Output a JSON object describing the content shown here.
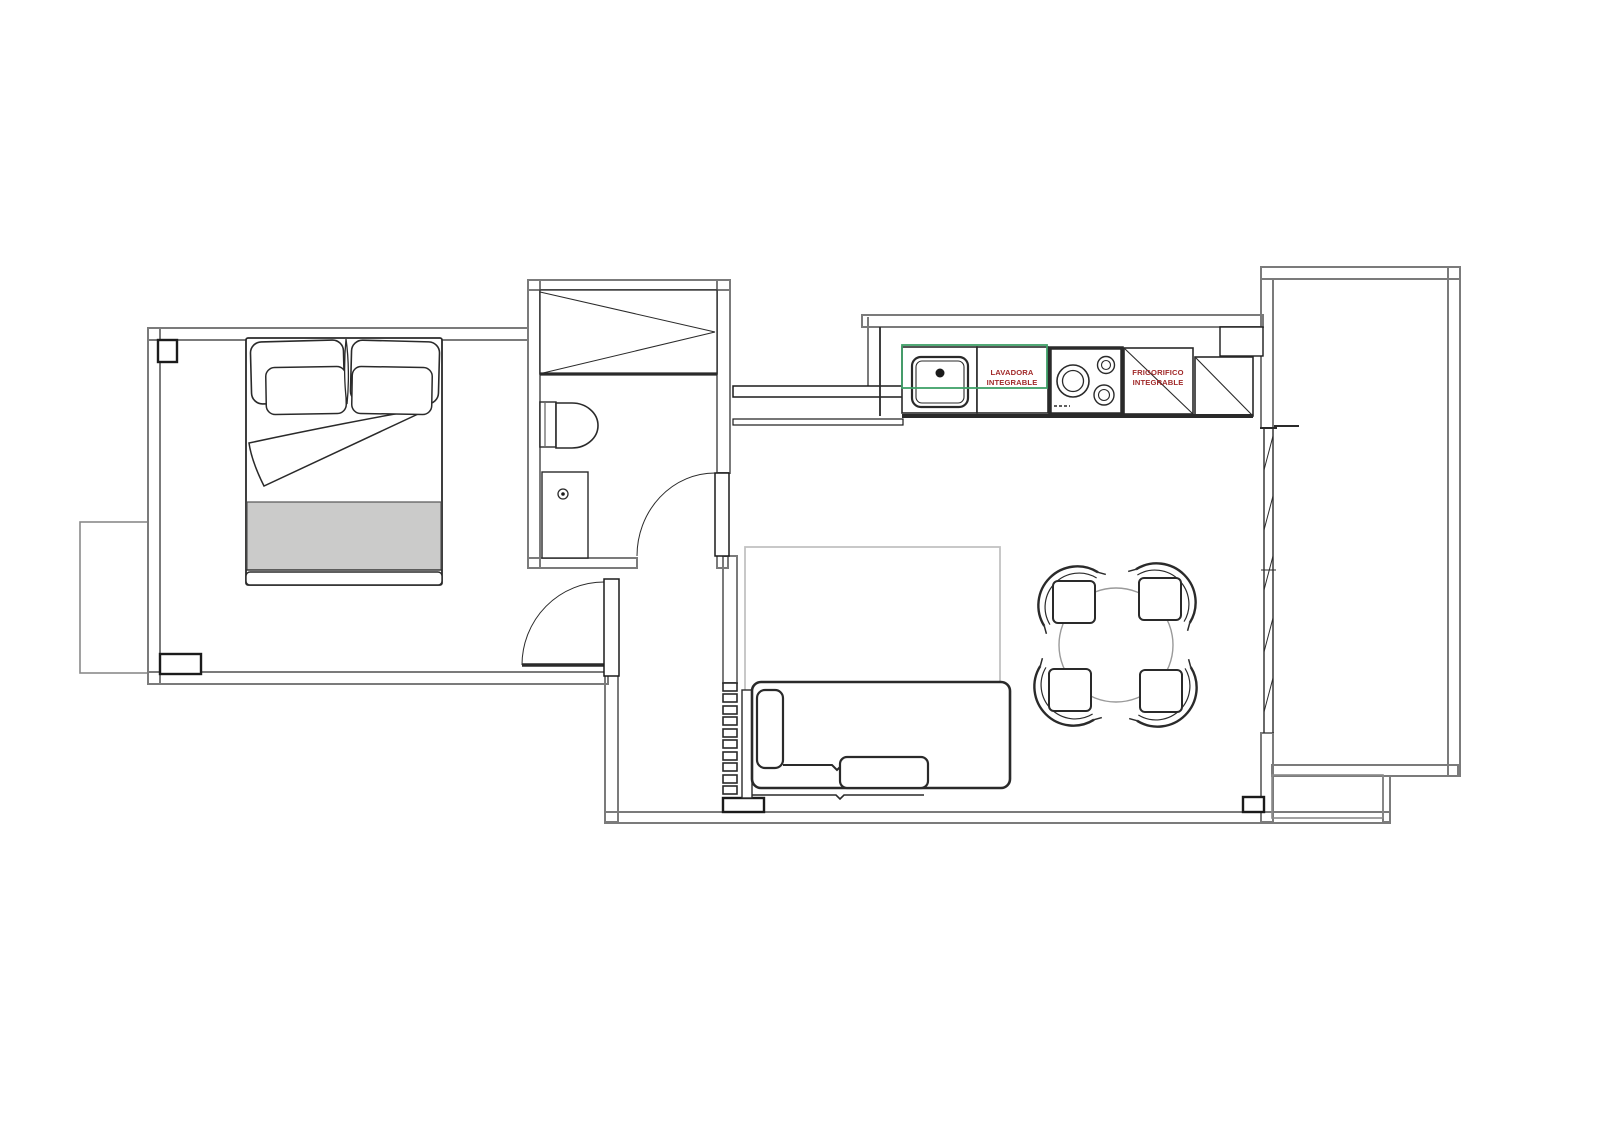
{
  "floorplan": {
    "kitchen": {
      "washer_label": {
        "line1": "LAVADORA",
        "line2": "INTEGRABLE"
      },
      "fridge_label": {
        "line1": "FRIGORIFICO",
        "line2": "INTEGRABLE"
      }
    },
    "colors": {
      "label_red": "#A12A2A",
      "highlight_green": "#3FA068",
      "wall_gray": "#7B7B7B",
      "line_black": "#1B1B1B",
      "rug_gray": "#C2C2C2",
      "blanket_fill": "#CBCBCA",
      "table_gray": "#9A9A9A"
    }
  }
}
